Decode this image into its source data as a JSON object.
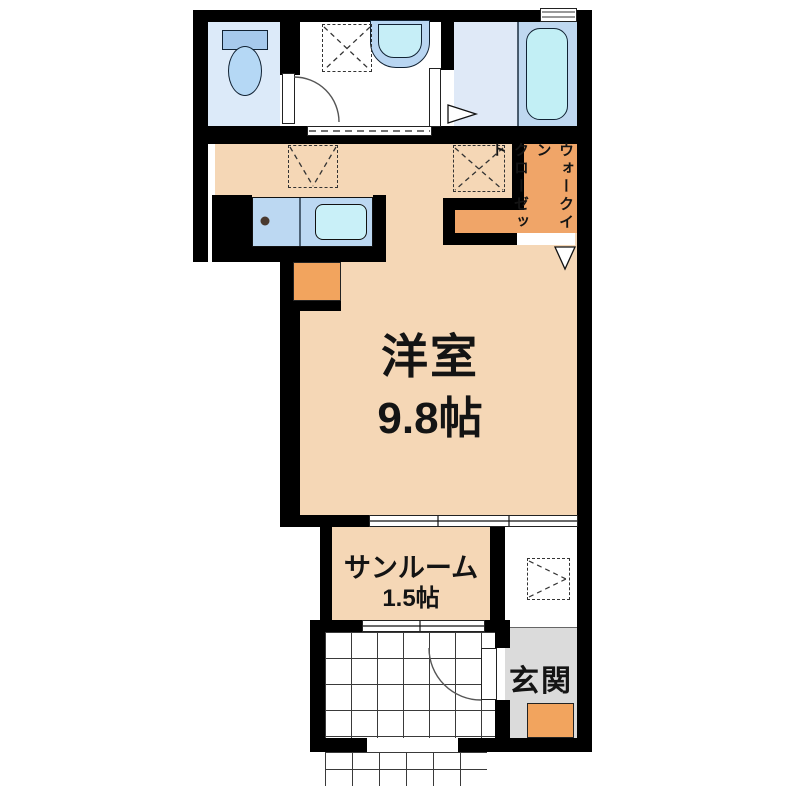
{
  "document": {
    "type": "floor-plan"
  },
  "rooms": {
    "main_room": {
      "label": "洋室",
      "size": "9.8帖"
    },
    "sunroom": {
      "label": "サンルーム",
      "size": "1.5帖"
    },
    "entrance": {
      "label": "玄関"
    },
    "walk_in_closet": {
      "label_line1": "ウォークイン",
      "label_line2": "クローゼット"
    }
  },
  "fixtures": {
    "toilet": "toilet",
    "vanity_sink": "vanity-sink",
    "washing_machine_space": "washing-machine-space",
    "bathtub": "bathtub",
    "kitchen_counter_sink": "kitchen-sink",
    "stove_burner": "stove-burner",
    "refrigerator_space": "refrigerator-space",
    "storage_space": "storage-space",
    "tiled_porch": "tiled-porch"
  },
  "colors": {
    "floor": "#F5D7B6",
    "closet_orange": "#F0A568",
    "accent_orange": "#F2A45E",
    "entrance_gray": "#DBDBDB",
    "toilet_floor": "#DCEAF9",
    "bath_floor": "#DFE9F7",
    "tub_fill": "#C2EFF5",
    "counter_blue": "#BCD8F2",
    "wall": "#000000"
  }
}
